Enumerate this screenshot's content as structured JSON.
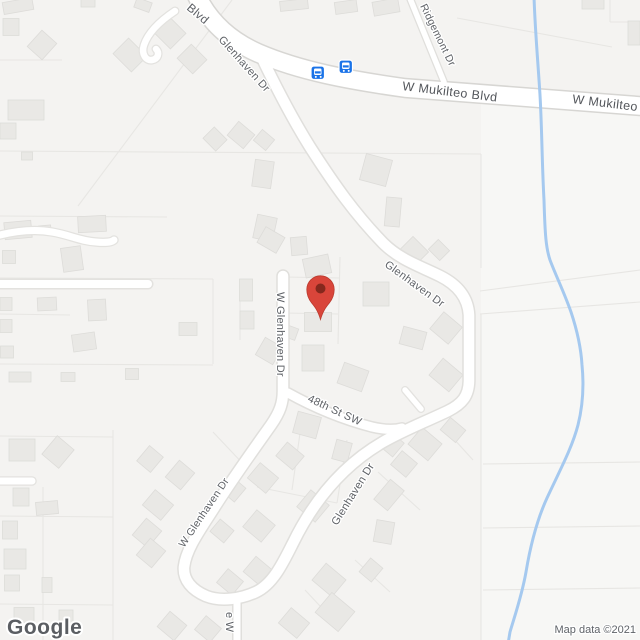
{
  "map": {
    "attribution": "Map data ©2021",
    "logo": "Google",
    "street_labels": [
      {
        "id": "blvd-partial-top",
        "text": "Blvd"
      },
      {
        "id": "glenhaven-dr-north",
        "text": "Glenhaven Dr"
      },
      {
        "id": "ridgemont-dr",
        "text": "Ridgemont Dr"
      },
      {
        "id": "w-mukilteo-blvd",
        "text": "W Mukilteo Blvd"
      },
      {
        "id": "w-mukilteo-partial",
        "text": "W Mukilteo"
      },
      {
        "id": "glenhaven-dr-mid",
        "text": "Glenhaven Dr"
      },
      {
        "id": "w-glenhaven-dr-upper",
        "text": "W Glenhaven Dr"
      },
      {
        "id": "48th-st-sw",
        "text": "48th St SW"
      },
      {
        "id": "glenhaven-dr-south",
        "text": "Glenhaven Dr"
      },
      {
        "id": "w-glenhaven-dr-lower",
        "text": "W Glenhaven Dr"
      },
      {
        "id": "street-partial-bottom",
        "text": "e W"
      }
    ],
    "marker": {
      "name": "red-location-pin",
      "fill": "#d9453a",
      "inner": "#85281d"
    },
    "transit_stops": {
      "count": 2,
      "color": "#1a73e8"
    },
    "colors": {
      "background": "#f4f3f1",
      "background_east": "#f7f7f5",
      "road_fill": "#ffffff",
      "road_casing": "#e0dfdc",
      "major_road_casing": "#d7d6d3",
      "building_fill": "#e9e8e5",
      "building_stroke": "#dddcd9",
      "parcel_line": "#e7e6e3",
      "water": "#a5c9ef",
      "label_text": "#5e6166"
    }
  }
}
